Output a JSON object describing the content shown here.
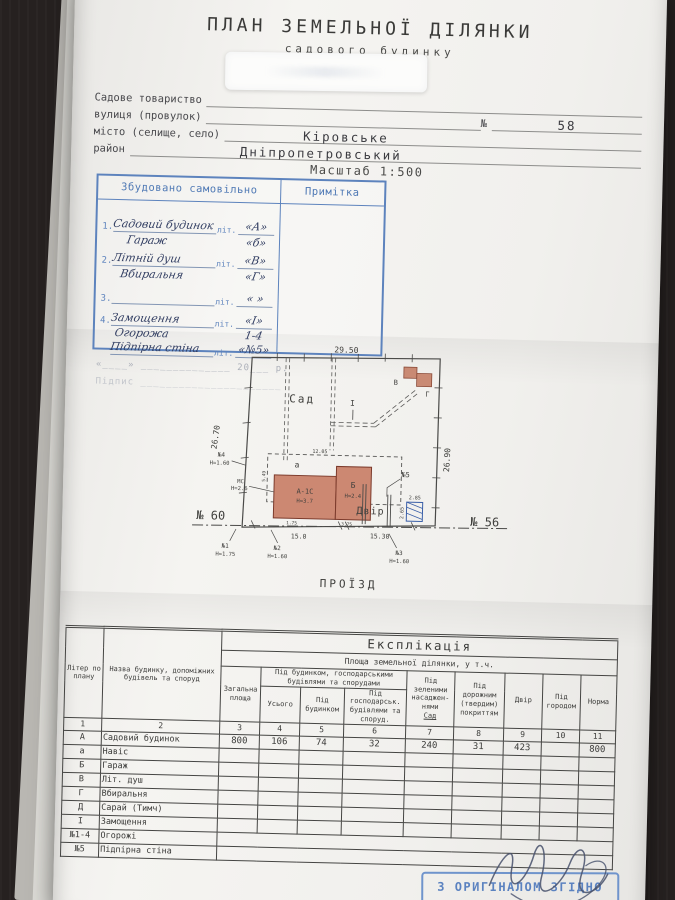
{
  "header": {
    "title": "ПЛАН ЗЕМЕЛЬНОЇ ДІЛЯНКИ",
    "subtitle": "садового будинку",
    "field_society": "Садове товариство",
    "field_street": "вулиця (провулок)",
    "street_no_label": "№",
    "street_no_value": "58",
    "field_city": "місто (селище, село)",
    "city_value": "Кіровське",
    "field_district": "район",
    "district_value": "Дніпропетровський",
    "scale": "Масштаб 1:500"
  },
  "self_built": {
    "title": "Збудовано самовільно",
    "note_title": "Примітка",
    "rows": [
      {
        "no": "1.",
        "name": "Садовий будинок",
        "lit": "літ.",
        "mark": "«А»"
      },
      {
        "no": "",
        "name": "Гараж",
        "lit": "",
        "mark": "«б»"
      },
      {
        "no": "2.",
        "name": "Літній душ",
        "lit": "літ.",
        "mark": "«В»"
      },
      {
        "no": "",
        "name": "Вбиральня",
        "lit": "",
        "mark": "«Г»"
      },
      {
        "no": "3.",
        "name": "",
        "lit": "літ.",
        "mark": "«  »"
      },
      {
        "no": "4.",
        "name": "Замощення",
        "lit": "літ.",
        "mark": "«І»"
      },
      {
        "no": "",
        "name": "Огорожа",
        "lit": "",
        "mark": "1-4"
      },
      {
        "no": "",
        "name": "Підпірна стіна",
        "lit": "літ.",
        "mark": "«№5»"
      }
    ],
    "date_line": "«____» ______________ 20___ р.",
    "sign_line": "Підпис ______________________"
  },
  "plan": {
    "dim_top": "29.50",
    "dim_left": "26.70",
    "dim_right": "26.90",
    "garden": "Сад",
    "yard": "Двір",
    "road": "ПРОЇЗД",
    "plot_no_left": "№ 60",
    "plot_no_right": "№ 56",
    "walk_label": "І",
    "house_label": "А-1С",
    "house_h": "Н=3.7",
    "garage_label": "Б",
    "garage_h": "Н=2.4",
    "canopy_label": "а",
    "shed_v_label": "В",
    "shed_g_label": "Г",
    "dim_canopy": "12.05",
    "dim_canopy_side": "5.49",
    "dim_house_1": "1.75",
    "dim_house_2": "3.75",
    "bin_w": "2.85",
    "bin_h": "2.65",
    "dim_street_1": "15.0",
    "dim_street_2": "15.30",
    "mk1": "№1",
    "mk1_h": "Н=1.75",
    "mk2": "№2",
    "mk2_h": "Н=1.60",
    "mk3": "№3",
    "mk3_h": "Н=1.60",
    "mk4": "№4",
    "mk4_h": "Н=1.60",
    "mk5": "№5",
    "mk_wall": "МС",
    "mk_wall_h": "Н=2.6"
  },
  "explication": {
    "title": "Експлікація",
    "hdr_area": "Площа земельної ділянки, у т.ч.",
    "hdr_liter": "Літер по плану",
    "hdr_name": "Назва будинку, допоміжних будівель та споруд",
    "hdr_total": "Загальна площа",
    "hdr_under_group": "Під будинком, господарськими будівлями та спорудами",
    "hdr_usogo": "Усього",
    "hdr_under_house": "Під будинком",
    "hdr_under_farm": "Під господарськ. будівлями та споруд.",
    "hdr_green": "Під зеленими насаджен- нями",
    "hdr_green_sub": "Сад",
    "hdr_road": "Під дорожним (твердим) покриттям",
    "hdr_yard": "Двір",
    "hdr_garden": "Під городом",
    "hdr_norm": "Норма",
    "col_numbers": [
      "1",
      "2",
      "3",
      "4",
      "5",
      "6",
      "7",
      "8",
      "9",
      "10",
      "11"
    ],
    "rows": [
      {
        "lit": "А",
        "name": "Садовий будинок",
        "v": [
          "800",
          "106",
          "74",
          "32",
          "240",
          "31",
          "423",
          "",
          "800"
        ]
      },
      {
        "lit": "а",
        "name": "Навіс",
        "v": [
          "",
          "",
          "",
          "",
          "",
          "",
          "",
          "",
          ""
        ]
      },
      {
        "lit": "Б",
        "name": "Гараж",
        "v": [
          "",
          "",
          "",
          "",
          "",
          "",
          "",
          "",
          ""
        ]
      },
      {
        "lit": "В",
        "name": "Літ. душ",
        "v": [
          "",
          "",
          "",
          "",
          "",
          "",
          "",
          "",
          ""
        ]
      },
      {
        "lit": "Г",
        "name": "Вбиральня",
        "v": [
          "",
          "",
          "",
          "",
          "",
          "",
          "",
          "",
          ""
        ]
      },
      {
        "lit": "Д",
        "name": "Сарай (Тимч)",
        "v": [
          "",
          "",
          "",
          "",
          "",
          "",
          "",
          "",
          ""
        ]
      },
      {
        "lit": "І",
        "name": "Замощення",
        "v": [
          "",
          "",
          "",
          "",
          "",
          "",
          "",
          "",
          ""
        ]
      },
      {
        "lit": "№1-4",
        "name": "Огорожі"
      },
      {
        "lit": "№5",
        "name": "Підпірна стіна"
      }
    ]
  },
  "stamp": {
    "text": "З ОРИГІНАЛОМ ЗГІДНО"
  }
}
